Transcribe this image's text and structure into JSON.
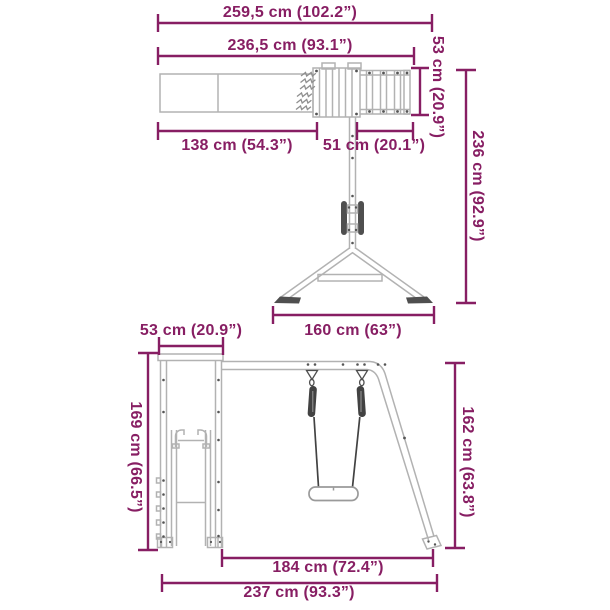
{
  "page": {
    "accent_color": "#871e63",
    "linework_color": "#b2b2b2",
    "hardware_color": "#424242",
    "background_color": "#ffffff"
  },
  "views": {
    "top": {
      "dims": {
        "total_width": "259,5 cm (102.2”)",
        "width_without_ladder": "236,5 cm (93.1”)",
        "ladder_depth": "53 cm (20.9”)",
        "total_depth": "236 cm (92.9”)",
        "slide_length": "138 cm (54.3”)",
        "platform_depth": "51 cm (20.1”)",
        "leg_span": "160 cm (63”)"
      }
    },
    "front": {
      "dims": {
        "tower_depth": "53 cm (20.9”)",
        "tower_height": "169 cm (66.5”)",
        "swing_frame_height": "162 cm (63.8”)",
        "swing_section_width": "184 cm (72.4”)",
        "total_width": "237 cm (93.3”)"
      }
    }
  }
}
